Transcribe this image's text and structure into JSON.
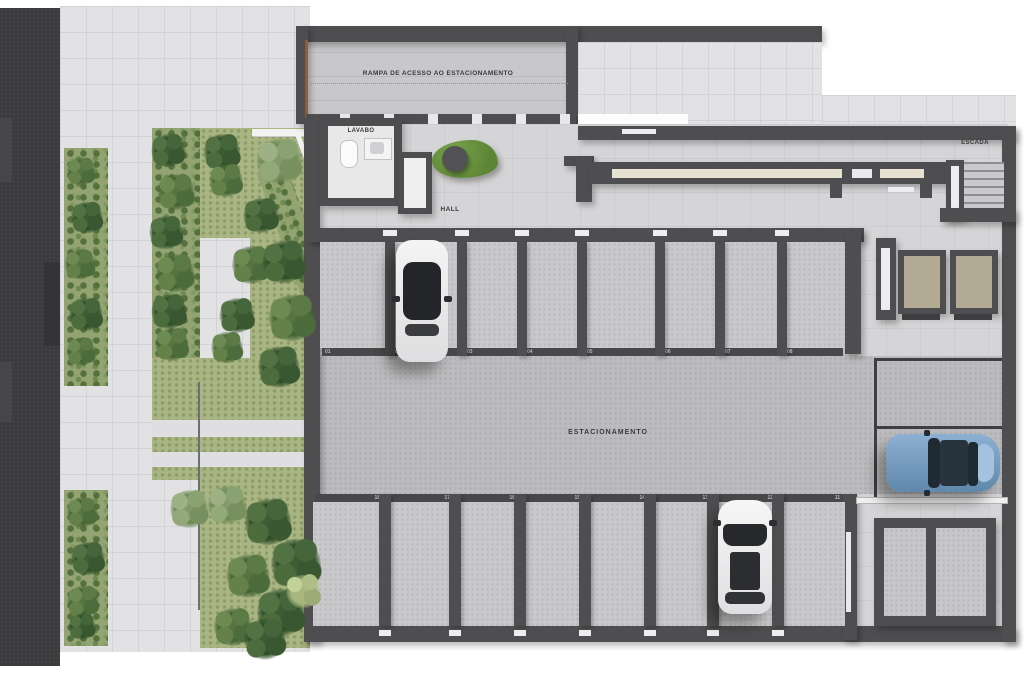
{
  "title": "Planta do pavimento térreo - estacionamento",
  "labels": {
    "ramp": "RAMPA DE ACESSO AO ESTACIONAMENTO",
    "lavabo": "LAVABO",
    "hall": "HALL",
    "escada": "ESCADA",
    "estacionamento": "ESTACIONAMENTO"
  },
  "parking": {
    "top_row_numbers": [
      "01",
      "02",
      "03",
      "04",
      "05",
      "06",
      "07",
      "08"
    ],
    "bottom_row_numbers": [
      "18",
      "17",
      "16",
      "15",
      "14",
      "13",
      "12",
      "11"
    ]
  },
  "colors": {
    "wall": "#4e4e50",
    "asphalt": "#3b3b3d",
    "pavement": "#e2e2e4",
    "hall_floor": "#d5d5d7",
    "stall_floor": "#c9c9cb",
    "aisle_floor": "#bcbcbe",
    "hedge": "#93a371",
    "grass": "#a9b583",
    "bench_green": "#6d9140",
    "elevator_floor": "#b3aa94",
    "wood_trim": "#8a5f3e",
    "car_white": "#f2f2f2",
    "car_blue": "#7fa6cc"
  }
}
